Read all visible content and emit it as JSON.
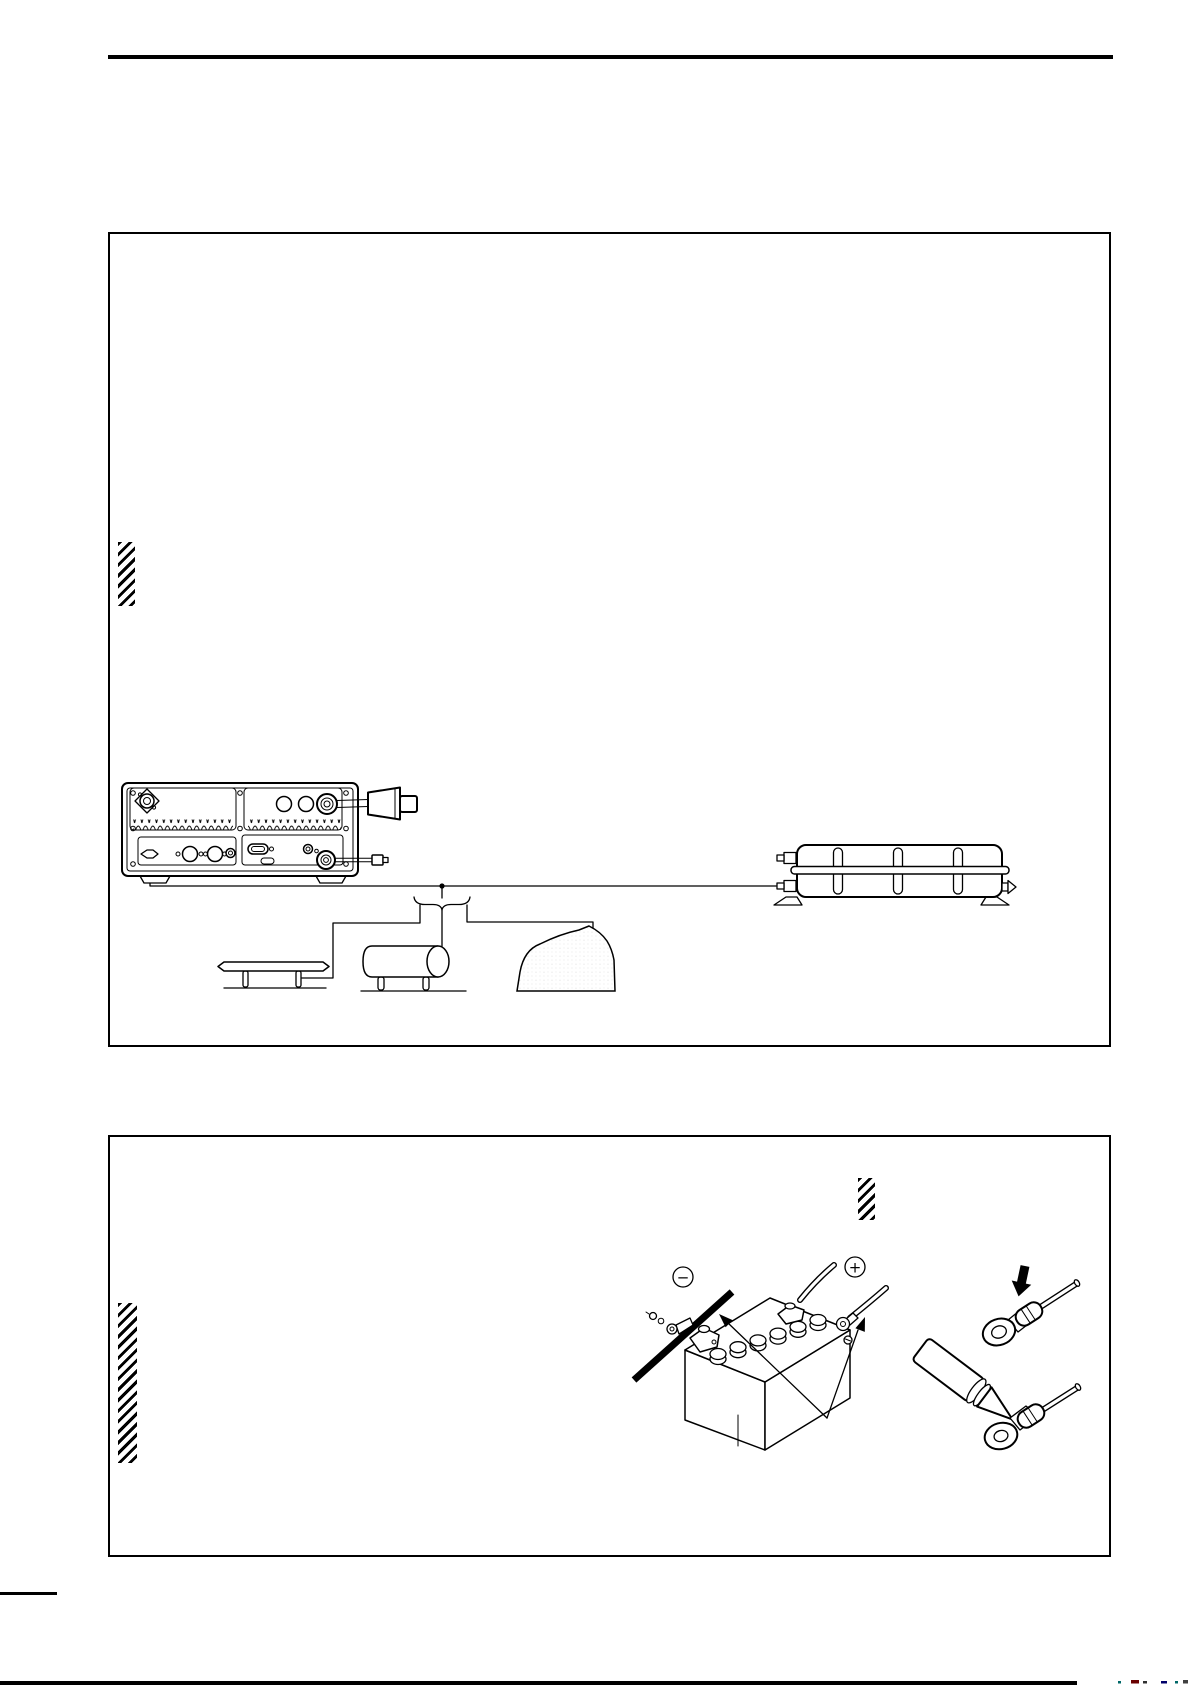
{
  "page": {
    "paper_color": "#ffffff",
    "ink_color": "#000000"
  },
  "figures": {
    "grounding": {
      "name": "grounding-diagram",
      "icons": [
        "transceiver-rear-panel-icon",
        "antenna-connector-icon",
        "power-plug-icon",
        "key-plug-icon",
        "ground-terminal-icon",
        "ground-wire",
        "antenna-tuner-icon",
        "ground-plate-icon",
        "water-pipe-icon",
        "earth-mound-icon"
      ]
    },
    "battery": {
      "name": "battery-connection-diagram",
      "negative_symbol": "−",
      "positive_symbol": "+",
      "icons": [
        "battery-icon",
        "negative-cable-icon",
        "positive-cable-icon",
        "ring-terminal-icon",
        "terminal-screw-icon",
        "pointer-arrow-icon"
      ]
    },
    "terminal": {
      "name": "ring-terminal-preparation",
      "icons": [
        "crimp-ring-terminal-icon",
        "press-arrow-icon",
        "wire-icon",
        "soldering-iron-icon"
      ]
    }
  },
  "footer": {
    "mark_colors": [
      "#006868",
      "#6a0000",
      "#303030",
      "#00006a",
      "#006868",
      "#404040"
    ]
  }
}
